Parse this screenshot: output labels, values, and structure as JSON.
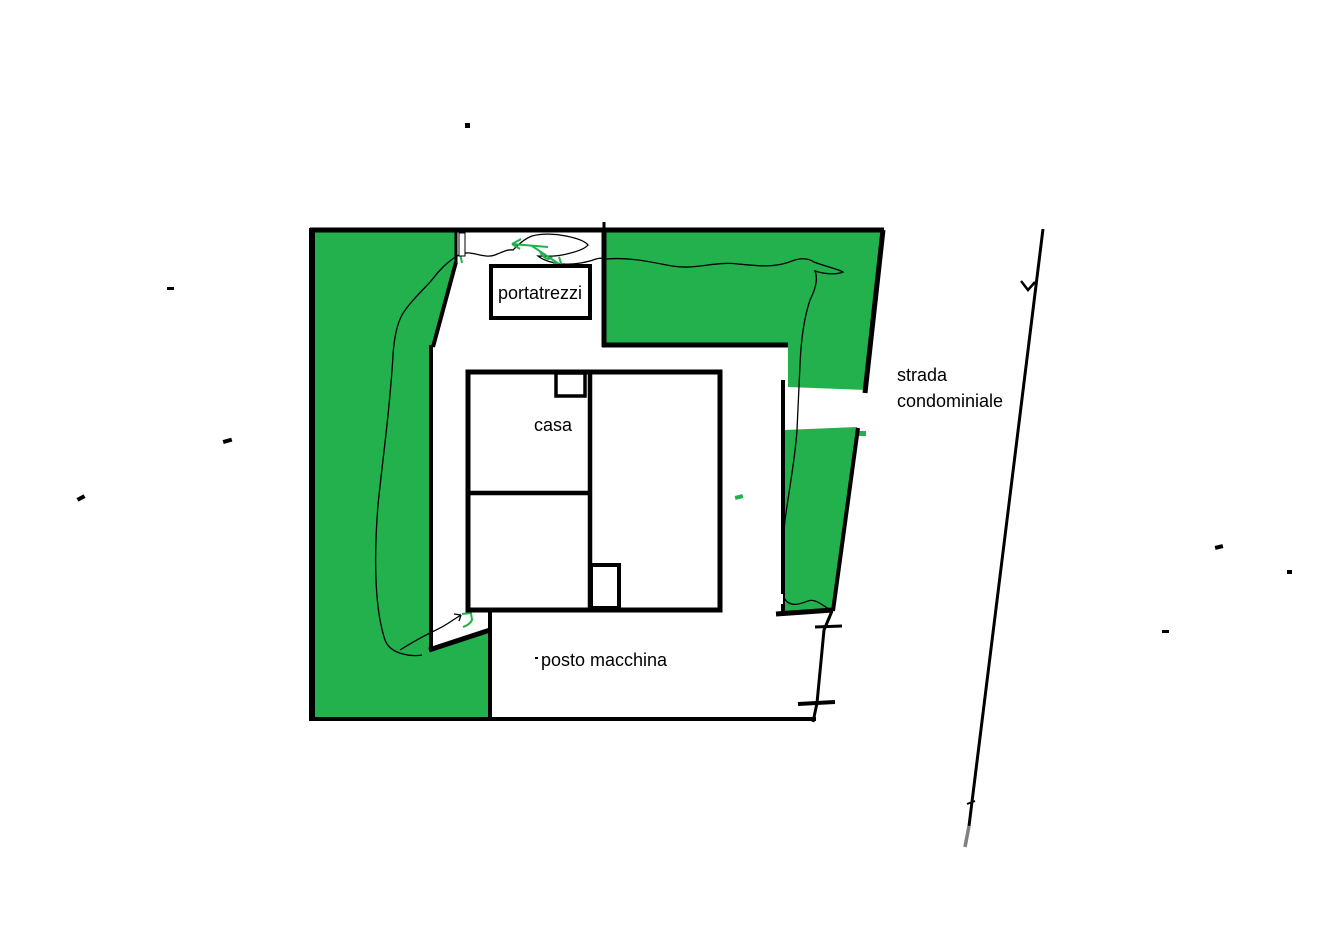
{
  "canvas": {
    "width": 1330,
    "height": 929,
    "background": "#ffffff",
    "description": "Hand-drawn property site plan sketch"
  },
  "colors": {
    "garden_green": "#22B14C",
    "line_black": "#000000",
    "road_tail_gray": "#808080",
    "white": "#ffffff",
    "text": "#000000"
  },
  "labels": {
    "shed": "portatrezzi",
    "house": "casa",
    "parking": "posto macchina",
    "road_line_1": "strada",
    "road_line_2": "condominiale"
  }
}
